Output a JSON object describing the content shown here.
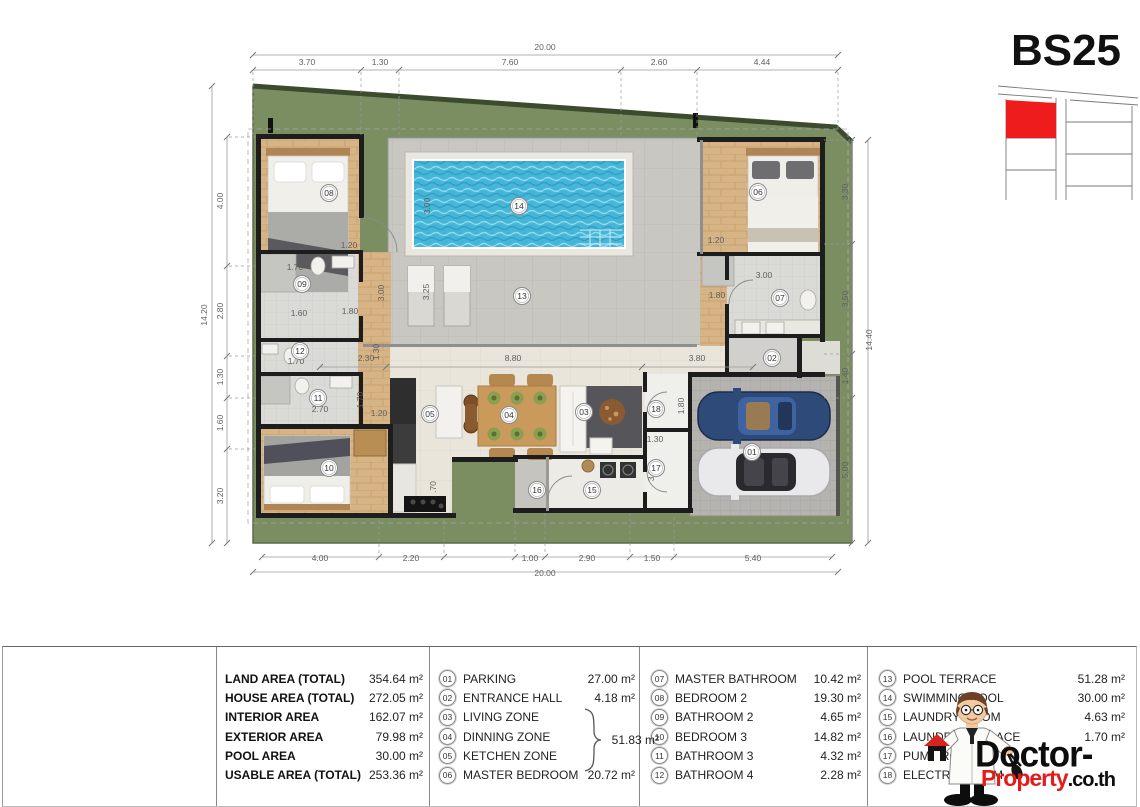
{
  "plan_code": "BS25",
  "colors": {
    "grass": "#7b8e62",
    "grass_edge": "#3c4a2e",
    "pool": "#45b6d8",
    "pool_light": "#8fdcef",
    "terrace": "#c9c7c2",
    "wood": "#d7b486",
    "tile": "#dadad6",
    "beige": "#e9e5db",
    "parking": "#b4b3af",
    "wall": "#1d1d1d",
    "accent_red": "#e31c1a",
    "plot_red": "#ee1c1c"
  },
  "plan": {
    "dims": {
      "top": [
        {
          "t": "20.00",
          "x": 545,
          "y": 50
        },
        {
          "t": "3.70",
          "x": 307,
          "y": 65
        },
        {
          "t": "1.30",
          "x": 380,
          "y": 65
        },
        {
          "t": "7.60",
          "x": 510,
          "y": 65
        },
        {
          "t": "2.60",
          "x": 659,
          "y": 65
        },
        {
          "t": "4.44",
          "x": 762,
          "y": 65
        }
      ],
      "left": [
        {
          "t": "14.20",
          "x": 207,
          "y": 315,
          "r": -90
        },
        {
          "t": "4.00",
          "x": 223,
          "y": 201,
          "r": -90
        },
        {
          "t": "2.80",
          "x": 223,
          "y": 311,
          "r": -90
        },
        {
          "t": "1.30",
          "x": 223,
          "y": 377,
          "r": -90
        },
        {
          "t": "1.60",
          "x": 223,
          "y": 423,
          "r": -90
        },
        {
          "t": "3.20",
          "x": 223,
          "y": 496,
          "r": -90
        }
      ],
      "right": [
        {
          "t": "14.40",
          "x": 872,
          "y": 340,
          "r": -90
        },
        {
          "t": "3.30",
          "x": 848,
          "y": 192,
          "r": -90
        },
        {
          "t": "3.50",
          "x": 848,
          "y": 299,
          "r": -90
        },
        {
          "t": "1.40",
          "x": 848,
          "y": 376,
          "r": -90
        },
        {
          "t": "5.00",
          "x": 848,
          "y": 470,
          "r": -90
        }
      ],
      "bottom": [
        {
          "t": "20.00",
          "x": 545,
          "y": 576
        },
        {
          "t": "4.00",
          "x": 320,
          "y": 561
        },
        {
          "t": "2.20",
          "x": 411,
          "y": 561
        },
        {
          "t": "1.00",
          "x": 530,
          "y": 561
        },
        {
          "t": "2.90",
          "x": 587,
          "y": 561
        },
        {
          "t": "1.50",
          "x": 652,
          "y": 561
        },
        {
          "t": "5.40",
          "x": 753,
          "y": 561
        }
      ],
      "interior": [
        {
          "t": "1.20",
          "x": 349,
          "y": 248
        },
        {
          "t": "1.70",
          "x": 295,
          "y": 270
        },
        {
          "t": "1.60",
          "x": 299,
          "y": 316
        },
        {
          "t": "1.80",
          "x": 350,
          "y": 314
        },
        {
          "t": "3.00",
          "x": 384,
          "y": 293,
          "r": -90
        },
        {
          "t": "1.30",
          "x": 379,
          "y": 352,
          "r": -90
        },
        {
          "t": "2.30",
          "x": 366,
          "y": 361
        },
        {
          "t": "8.80",
          "x": 513,
          "y": 361
        },
        {
          "t": "3.80",
          "x": 697,
          "y": 361
        },
        {
          "t": "3.25",
          "x": 429,
          "y": 292,
          "r": -90
        },
        {
          "t": "3.00",
          "x": 430,
          "y": 206,
          "r": -90
        },
        {
          "t": "1.20",
          "x": 716,
          "y": 243
        },
        {
          "t": "1.80",
          "x": 717,
          "y": 298
        },
        {
          "t": "3.00",
          "x": 764,
          "y": 278
        },
        {
          "t": "1.70",
          "x": 296,
          "y": 364
        },
        {
          "t": "2.70",
          "x": 320,
          "y": 412
        },
        {
          "t": "1.70",
          "x": 363,
          "y": 400,
          "r": -90
        },
        {
          "t": "1.20",
          "x": 379,
          "y": 416
        },
        {
          "t": ".70",
          "x": 436,
          "y": 487,
          "r": -90
        },
        {
          "t": "1.80",
          "x": 684,
          "y": 406,
          "r": -90
        },
        {
          "t": "1.30",
          "x": 655,
          "y": 442
        },
        {
          "t": "3.00",
          "x": 654,
          "y": 473,
          "r": -90
        }
      ]
    },
    "room_markers": [
      {
        "no": "01",
        "x": 752,
        "y": 452
      },
      {
        "no": "02",
        "x": 772,
        "y": 358
      },
      {
        "no": "03",
        "x": 584,
        "y": 412
      },
      {
        "no": "04",
        "x": 509,
        "y": 415
      },
      {
        "no": "05",
        "x": 430,
        "y": 414
      },
      {
        "no": "06",
        "x": 758,
        "y": 192
      },
      {
        "no": "07",
        "x": 780,
        "y": 298
      },
      {
        "no": "08",
        "x": 329,
        "y": 193
      },
      {
        "no": "09",
        "x": 302,
        "y": 284
      },
      {
        "no": "10",
        "x": 329,
        "y": 468
      },
      {
        "no": "11",
        "x": 318,
        "y": 398
      },
      {
        "no": "12",
        "x": 300,
        "y": 351
      },
      {
        "no": "13",
        "x": 522,
        "y": 296
      },
      {
        "no": "14",
        "x": 519,
        "y": 206
      },
      {
        "no": "15",
        "x": 592,
        "y": 490
      },
      {
        "no": "16",
        "x": 537,
        "y": 490
      },
      {
        "no": "17",
        "x": 656,
        "y": 468
      },
      {
        "no": "18",
        "x": 656,
        "y": 409
      }
    ]
  },
  "legend": {
    "area_table": [
      {
        "label": "LAND AREA (TOTAL)",
        "value": "354.64 m²"
      },
      {
        "label": "HOUSE AREA (TOTAL)",
        "value": "272.05 m²"
      },
      {
        "label": "INTERIOR AREA",
        "value": "162.07 m²"
      },
      {
        "label": "EXTERIOR AREA",
        "value": "79.98 m²"
      },
      {
        "label": "POOL AREA",
        "value": "30.00 m²"
      },
      {
        "label": "USABLE AREA (TOTAL)",
        "value": "253.36 m²"
      }
    ],
    "room_columns": [
      [
        {
          "no": "01",
          "name": "PARKING",
          "area": "27.00 m²"
        },
        {
          "no": "02",
          "name": "ENTRANCE HALL",
          "area": "4.18 m²"
        },
        {
          "no": "03",
          "name": "LIVING ZONE",
          "area": ""
        },
        {
          "no": "04",
          "name": "DINNING ZONE",
          "area": ""
        },
        {
          "no": "05",
          "name": "KETCHEN ZONE",
          "area": ""
        },
        {
          "no": "06",
          "name": "MASTER BEDROOM",
          "area": "20.72 m²"
        }
      ],
      [
        {
          "no": "07",
          "name": "MASTER BATHROOM",
          "area": "10.42 m²"
        },
        {
          "no": "08",
          "name": "BEDROOM 2",
          "area": "19.30 m²"
        },
        {
          "no": "09",
          "name": "BATHROOM 2",
          "area": "4.65 m²"
        },
        {
          "no": "10",
          "name": "BEDROOM 3",
          "area": "14.82 m²"
        },
        {
          "no": "11",
          "name": "BATHROOM 3",
          "area": "4.32 m²"
        },
        {
          "no": "12",
          "name": "BATHROOM 4",
          "area": "2.28 m²"
        }
      ],
      [
        {
          "no": "13",
          "name": "POOL TERRACE",
          "area": "51.28 m²"
        },
        {
          "no": "14",
          "name": "SWIMMING POOL",
          "area": "30.00 m²"
        },
        {
          "no": "15",
          "name": "LAUNDRY ROOM",
          "area": "4.63 m²"
        },
        {
          "no": "16",
          "name": "LAUNDRY TERRACE",
          "area": "1.70 m²"
        },
        {
          "no": "17",
          "name": "PUMP ROOM",
          "area": ""
        },
        {
          "no": "18",
          "name": "ELECTRIC ROOM",
          "area": ""
        }
      ]
    ],
    "group_value": "51.83 m²"
  },
  "logo": {
    "black": "Doctor-",
    "red": "Property",
    "suffix": ".co.th"
  }
}
